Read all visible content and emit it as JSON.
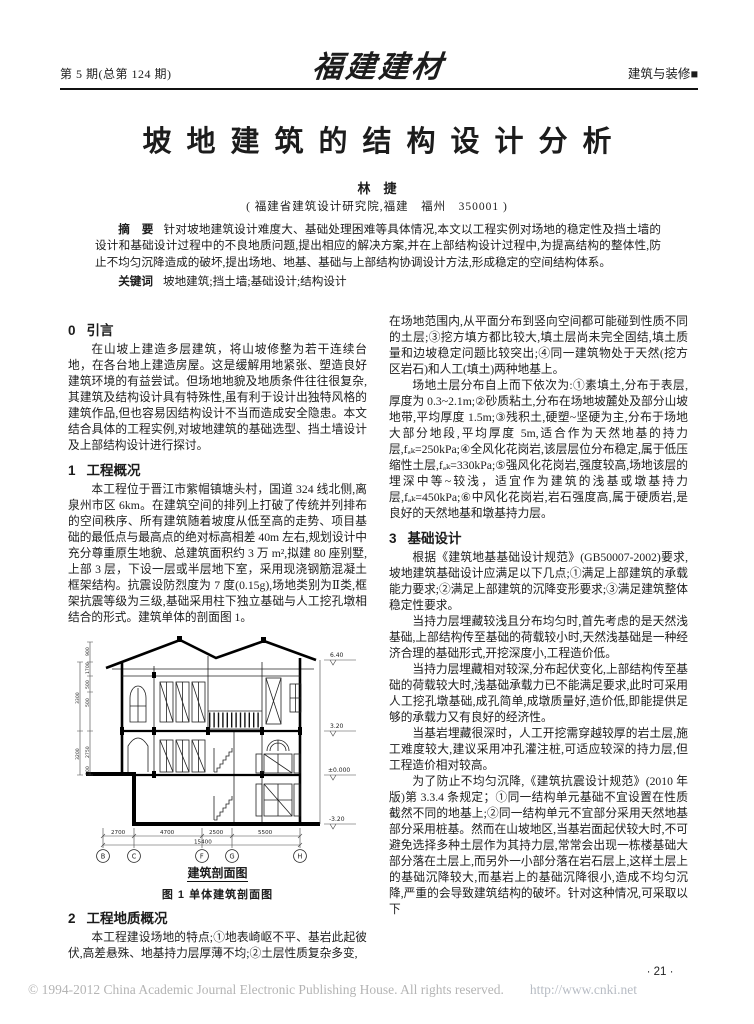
{
  "header": {
    "issue": "第 5 期(总第 124 期)",
    "journal": "福建建材",
    "section": "建筑与装修",
    "section_marker": "■"
  },
  "article": {
    "title": "坡地建筑的结构设计分析",
    "author": "林　捷",
    "affiliation": "( 福建省建筑设计研究院,福建　福州　350001 )",
    "abstract_label": "摘　要",
    "abstract": "针对坡地建筑设计难度大、基础处理困难等具体情况,本文以工程实例对场地的稳定性及挡土墙的设计和基础设计过程中的不良地质问题,提出相应的解决方案,并在上部结构设计过程中,为提高结构的整体性,防止不均匀沉降造成的破坏,提出场地、地基、基础与上部结构协调设计方法,形成稳定的空间结构体系。",
    "keywords_label": "关键词",
    "keywords": "坡地建筑;挡土墙;基础设计;结构设计"
  },
  "left_column": {
    "h0": {
      "no": "0",
      "title": "引言"
    },
    "p0": "在山坡上建造多层建筑，将山坡修整为若干连续台地，在各台地上建造房屋。这是缓解用地紧张、塑造良好建筑环境的有益尝试。但场地地貌及地质条件往往很复杂,其建筑及结构设计具有特殊性,虽有利于设计出独特风格的建筑作品,但也容易因结构设计不当而造成安全隐患。本文结合具体的工程实例,对坡地建筑的基础选型、挡土墙设计及上部结构设计进行探讨。",
    "h1": {
      "no": "1",
      "title": "工程概况"
    },
    "p1": "本工程位于晋江市紫帽镇塘头村，国道 324 线北侧,离泉州市区 6km。在建筑空间的排列上打破了传统并列排布的空间秩序、所有建筑随着坡度从低至高的走势、项目基础的最低点与最高点的绝对标高相差 40m 左右,规划设计中充分尊重原生地貌、总建筑面积约 3 万 m²,拟建 80 座别墅,上部 3 层，下设一层或半层地下室，采用现浇钢筋混凝土框架结构。抗震设防烈度为 7 度(0.15g),场地类别为Ⅱ类,框架抗震等级为三级,基础采用柱下独立基础与人工挖孔墩相结合的形式。建筑单体的剖面图 1。",
    "h2": {
      "no": "2",
      "title": "工程地质概况"
    },
    "p2": "本工程建设场地的特点;①地表崎岖不平、基岩此起彼伏,高差悬殊、地基持力层厚薄不均;②土层性质复杂多变,"
  },
  "right_column": {
    "p_cont1": "在场地范围内,从平面分布到竖向空间都可能碰到性质不同的土层;③挖方填方都比较大,填土层尚未完全固结,填土质量和边坡稳定问题比较突出;④同一建筑物处于天然(挖方区岩石)和人工(填土)两种地基上。",
    "p_cont2": "场地土层分布自上而下依次为:①素填土,分布于表层,厚度为 0.3~2.1m;②砂质粘土,分布在场地坡麓处及部分山坡地带,平均厚度 1.5m;③残积土,硬塑~坚硬为主,分布于场地大部分地段,平均厚度 5m,适合作为天然地基的持力层,fₐₖ=250kPa;④全风化花岗岩,该层层位分布稳定,属于低压缩性土层,fₐₖ=330kPa;⑤强风化花岗岩,强度较高,场地该层的埋深中等~较浅，适宜作为建筑的浅基或墩基持力层,fₐₖ=450kPa;⑥中风化花岗岩,岩石强度高,属于硬质岩,是良好的天然地基和墩基持力层。",
    "h3": {
      "no": "3",
      "title": "基础设计"
    },
    "p1": "根据《建筑地基基础设计规范》(GB50007-2002)要求,坡地建筑基础设计应满足以下几点;①满足上部建筑的承载能力要求;②满足上部建筑的沉降变形要求;③满足建筑整体稳定性要求。",
    "p2": "当持力层埋藏较浅且分布均匀时,首先考虑的是天然浅基础,上部结构传至基础的荷载较小时,天然浅基础是一种经济合理的基础形式,开挖深度小,工程造价低。",
    "p3": "当持力层埋藏相对较深,分布起伏变化,上部结构传至基础的荷载较大时,浅基础承载力已不能满足要求,此时可采用人工挖孔墩基础,成孔简单,成墩质量好,造价低,即能提供足够的承载力又有良好的经济性。",
    "p4": "当基岩埋藏很深时，人工开挖需穿越较厚的岩土层,施工难度较大,建议采用冲孔灌注桩,可适应较深的持力层,但工程造价相对较高。",
    "p5": "为了防止不均匀沉降,《建筑抗震设计规范》(2010 年版)第 3.3.4 条规定；①同一结构单元基础不宜设置在性质截然不同的地基上;②同一结构单元不宜部分采用天然地基部分采用桩基。然而在山坡地区,当基岩面起伏较大时,不可避免选择多种土层作为其持力层,常常会出现一栋楼基础大部分落在土层上,而另外一小部分落在岩石层上,这样土层上的基础沉降较大,而基岩上的基础沉降很小,造成不均匀沉降,严重的会导致建筑结构的破坏。针对这种情况,可采取以下"
  },
  "figure": {
    "inner_caption": "建筑剖面图",
    "caption": "图 1  单体建筑剖面图",
    "grid_labels": [
      "B",
      "C",
      "F",
      "G",
      "H"
    ],
    "dims_bottom": [
      "2700",
      "4700",
      "2500",
      "5500"
    ],
    "dim_total": "15400",
    "dims_left_inner": [
      "900",
      "1700",
      "500",
      "500",
      "2750",
      "500"
    ],
    "dims_left_outer": [
      "3300",
      "3200"
    ],
    "elevations": [
      "6.40",
      "3.20",
      "±0.000",
      "-3.20"
    ]
  },
  "footer": {
    "copyright": "© 1994-2012 China Academic Journal Electronic Publishing House. All rights reserved.",
    "url": "http://www.cnki.net",
    "page_number": "· 21 ·"
  }
}
